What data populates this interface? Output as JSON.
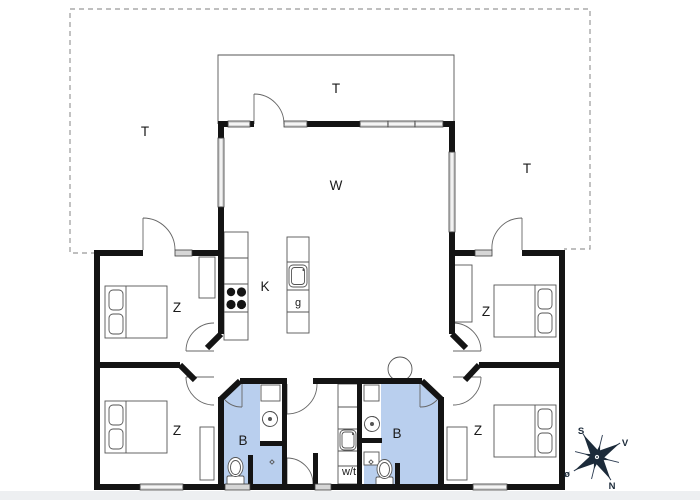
{
  "floorplan": {
    "labels": {
      "terrace_left": "T",
      "terrace_top": "T",
      "terrace_right": "T",
      "living_room": "W",
      "kitchen": "K",
      "island": "g",
      "bedroom_top_left": "Z",
      "bedroom_bottom_left": "Z",
      "bedroom_top_right": "Z",
      "bedroom_bottom_right": "Z",
      "bathroom_left": "B",
      "bathroom_right": "B",
      "utility_room": "w/t"
    },
    "compass": {
      "south": "S",
      "west": "V",
      "north": "N",
      "east": "ø"
    },
    "colors": {
      "wall": "#141414",
      "bathroom_fill": "#b9cfee",
      "window_fill": "#d6d6d6",
      "compass": "#1c2b3a",
      "outline": "#555555"
    }
  }
}
